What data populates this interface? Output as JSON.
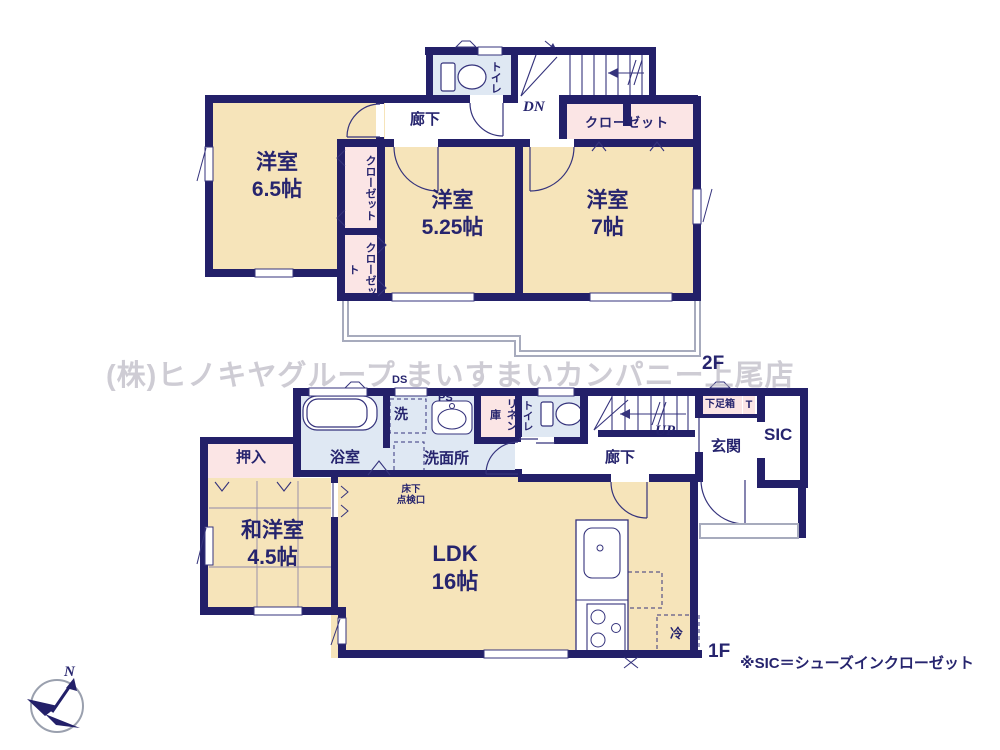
{
  "watermark_text": "(株)ヒノキヤグループ まいすまいカンパニー上尾店",
  "note": "※SIC＝シューズインクローゼット",
  "compass": {
    "north_label": "N"
  },
  "colors": {
    "wall": "#232069",
    "room_fill": "#f6e4ba",
    "closet_fill": "#fbe5e5",
    "wet_fill": "#dfe8f3",
    "thin_line": "#35337c",
    "balcony_line": "#a7abbd",
    "watermark": "#a6a3b0"
  },
  "floor2": {
    "floor_label": "2F",
    "room_65": "洋室\n6.5帖",
    "room_525": "洋室\n5.25帖",
    "room_7": "洋室\n7帖",
    "closet_left_upper": "クローゼット",
    "closet_left_lower": "クローゼット",
    "closet_right": "クローゼット",
    "hallway": "廊下",
    "toilet": "トイレ",
    "stairs_down": "DN"
  },
  "floor1": {
    "floor_label": "1F",
    "ldk": "LDK\n16帖",
    "japanese_room": "和洋室\n4.5帖",
    "oshiire": "押入",
    "bathroom": "浴室",
    "washroom": "洗面所",
    "laundry": "洗",
    "pipe_space": "PS",
    "duct_space": "DS",
    "linen_closet": "リネン庫",
    "toilet": "トイレ",
    "hallway": "廊下",
    "stairs_up": "UP",
    "entrance": "玄関",
    "shoe_in_closet": "SIC",
    "shoe_box": "下足箱",
    "shoe_box_t": "T",
    "refrigerator": "冷",
    "floor_hatch": "床下\n点検口"
  }
}
